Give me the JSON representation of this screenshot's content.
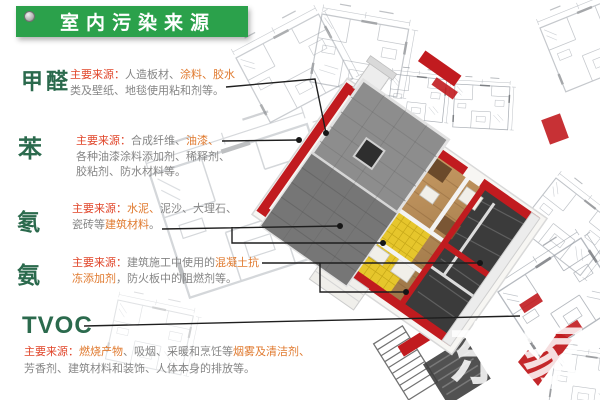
{
  "header": {
    "title": "室内污染来源"
  },
  "sections": [
    {
      "id": "jiaquan",
      "label": "甲醛",
      "lines": [
        [
          {
            "t": "主要来源："
          },
          {
            "t": "人造板材、"
          },
          {
            "t": "涂料、胶水"
          }
        ],
        [
          {
            "t": "类及壁纸、地毯使用粘和剂等。"
          }
        ]
      ]
    },
    {
      "id": "ben",
      "label": "苯",
      "lines": [
        [
          {
            "t": "主要来源："
          },
          {
            "t": "合成纤维、"
          },
          {
            "t": "油漆、"
          }
        ],
        [
          {
            "t": "各种油漆涂料添加剂、稀释剂、"
          }
        ],
        [
          {
            "t": "胶粘剂、防水材料等。"
          }
        ]
      ]
    },
    {
      "id": "dong",
      "label": "氡",
      "lines": [
        [
          {
            "t": "主要来源："
          },
          {
            "t": "水泥、"
          },
          {
            "t": "泥沙、大理石、"
          }
        ],
        [
          {
            "t": "瓷砖等"
          },
          {
            "t": "建筑材料"
          },
          {
            "t": "。"
          }
        ]
      ]
    },
    {
      "id": "an",
      "label": "氨",
      "lines": [
        [
          {
            "t": "主要来源："
          },
          {
            "t": "建筑施工中使用的"
          },
          {
            "t": "混凝土抗"
          }
        ],
        [
          {
            "t": "冻添加剂"
          },
          {
            "t": "，防火板中的阻燃剂等。"
          }
        ]
      ]
    },
    {
      "id": "tvoc",
      "label": "TVOC",
      "lines": [
        [
          {
            "t": "主要来源："
          },
          {
            "t": "燃烧产物"
          },
          {
            "t": "、吸烟、采暖和烹饪等"
          },
          {
            "t": "烟雾及清洁剂、"
          }
        ],
        [
          {
            "t": "芳香剂、建筑材料和装饰、人体本身的排放等。"
          }
        ]
      ]
    }
  ],
  "watermark": {
    "text": "东家"
  },
  "colors": {
    "banner_green": "#2ba14b",
    "label_green": "#2b6a4d",
    "source_red": "#e0452a",
    "highlight_orange": "#e07a2f",
    "body_gray": "#858585",
    "wall_red": "#c11b1f",
    "roof_gray": "#8d8d8d",
    "floor_wood": "#c79a63",
    "kitchen_yellow": "#e6c62c"
  }
}
